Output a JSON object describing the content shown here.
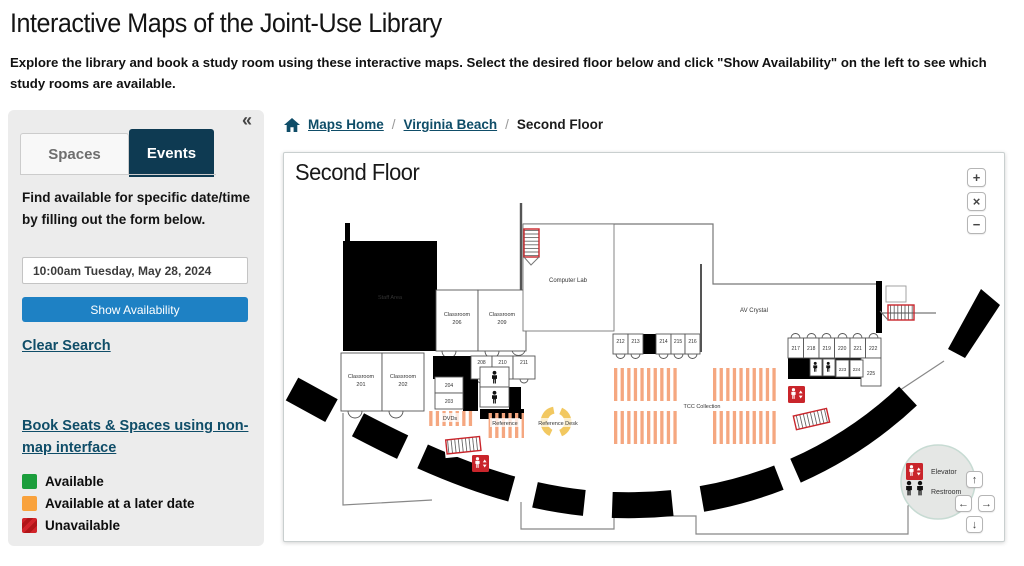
{
  "page": {
    "title": "Interactive Maps of the Joint-Use Library",
    "subtitle": "Explore the library and book a study room using these interactive maps. Select the desired floor below and click \"Show Availability\" on the left to see which study rooms are available."
  },
  "sidebar": {
    "collapse_icon": "«",
    "tabs": [
      {
        "label": "Spaces"
      },
      {
        "label": "Events"
      }
    ],
    "intro": "Find available for specific date/time by filling out the form below.",
    "datetime_value": "10:00am Tuesday, May 28, 2024",
    "show_availability_label": "Show Availability",
    "clear_search_label": "Clear Search",
    "book_link_label": "Book Seats & Spaces using non-map interface",
    "legend": [
      {
        "label": "Available",
        "color": "#1b9e3c"
      },
      {
        "label": "Available at a later date",
        "color": "#f9a23c"
      },
      {
        "label": "Unavailable",
        "color": "#d2232a"
      }
    ]
  },
  "breadcrumb": {
    "separator": "/",
    "items": [
      {
        "label": "Maps Home"
      },
      {
        "label": "Virginia Beach"
      },
      {
        "label": "Second Floor"
      }
    ]
  },
  "map": {
    "title": "Second Floor",
    "zoom_controls": {
      "zoom_in": "+",
      "close": "×",
      "zoom_out": "−"
    },
    "pan_controls": {
      "up": "↑",
      "left": "←",
      "right": "→",
      "down": "↓"
    },
    "corner_legend": {
      "elevator": "Elevator",
      "restroom": "Restroom"
    },
    "labels": {
      "staff_area": "Staff Area",
      "computer_lab": "Computer Lab",
      "av_crystal": "AV Crystal",
      "tcc_collection": "TCC Collection",
      "dvds": "DVDs",
      "reference": "Reference",
      "reference_desk": "Reference Desk"
    },
    "classrooms": {
      "c201": {
        "line1": "Classroom",
        "line2": "201"
      },
      "c202": {
        "line1": "Classroom",
        "line2": "202"
      },
      "c206": {
        "line1": "Classroom",
        "line2": "206"
      },
      "c209": {
        "line1": "Classroom",
        "line2": "209"
      }
    },
    "rooms": {
      "r203": "203",
      "r204": "204",
      "r208": "208",
      "r210": "210",
      "r211": "211",
      "r212": "212",
      "r213": "213",
      "r214": "214",
      "r215": "215",
      "r216": "216",
      "r217": "217",
      "r218": "218",
      "r219": "219",
      "r220": "220",
      "r221": "221",
      "r222": "222",
      "r223": "223",
      "r224": "224",
      "r225": "225"
    },
    "colors": {
      "stacks": "#f5a780",
      "reference_desk": "#f2c860",
      "alert_red": "#c9252b",
      "navy": "#0e3a52",
      "button_blue": "#1e81c4"
    }
  }
}
